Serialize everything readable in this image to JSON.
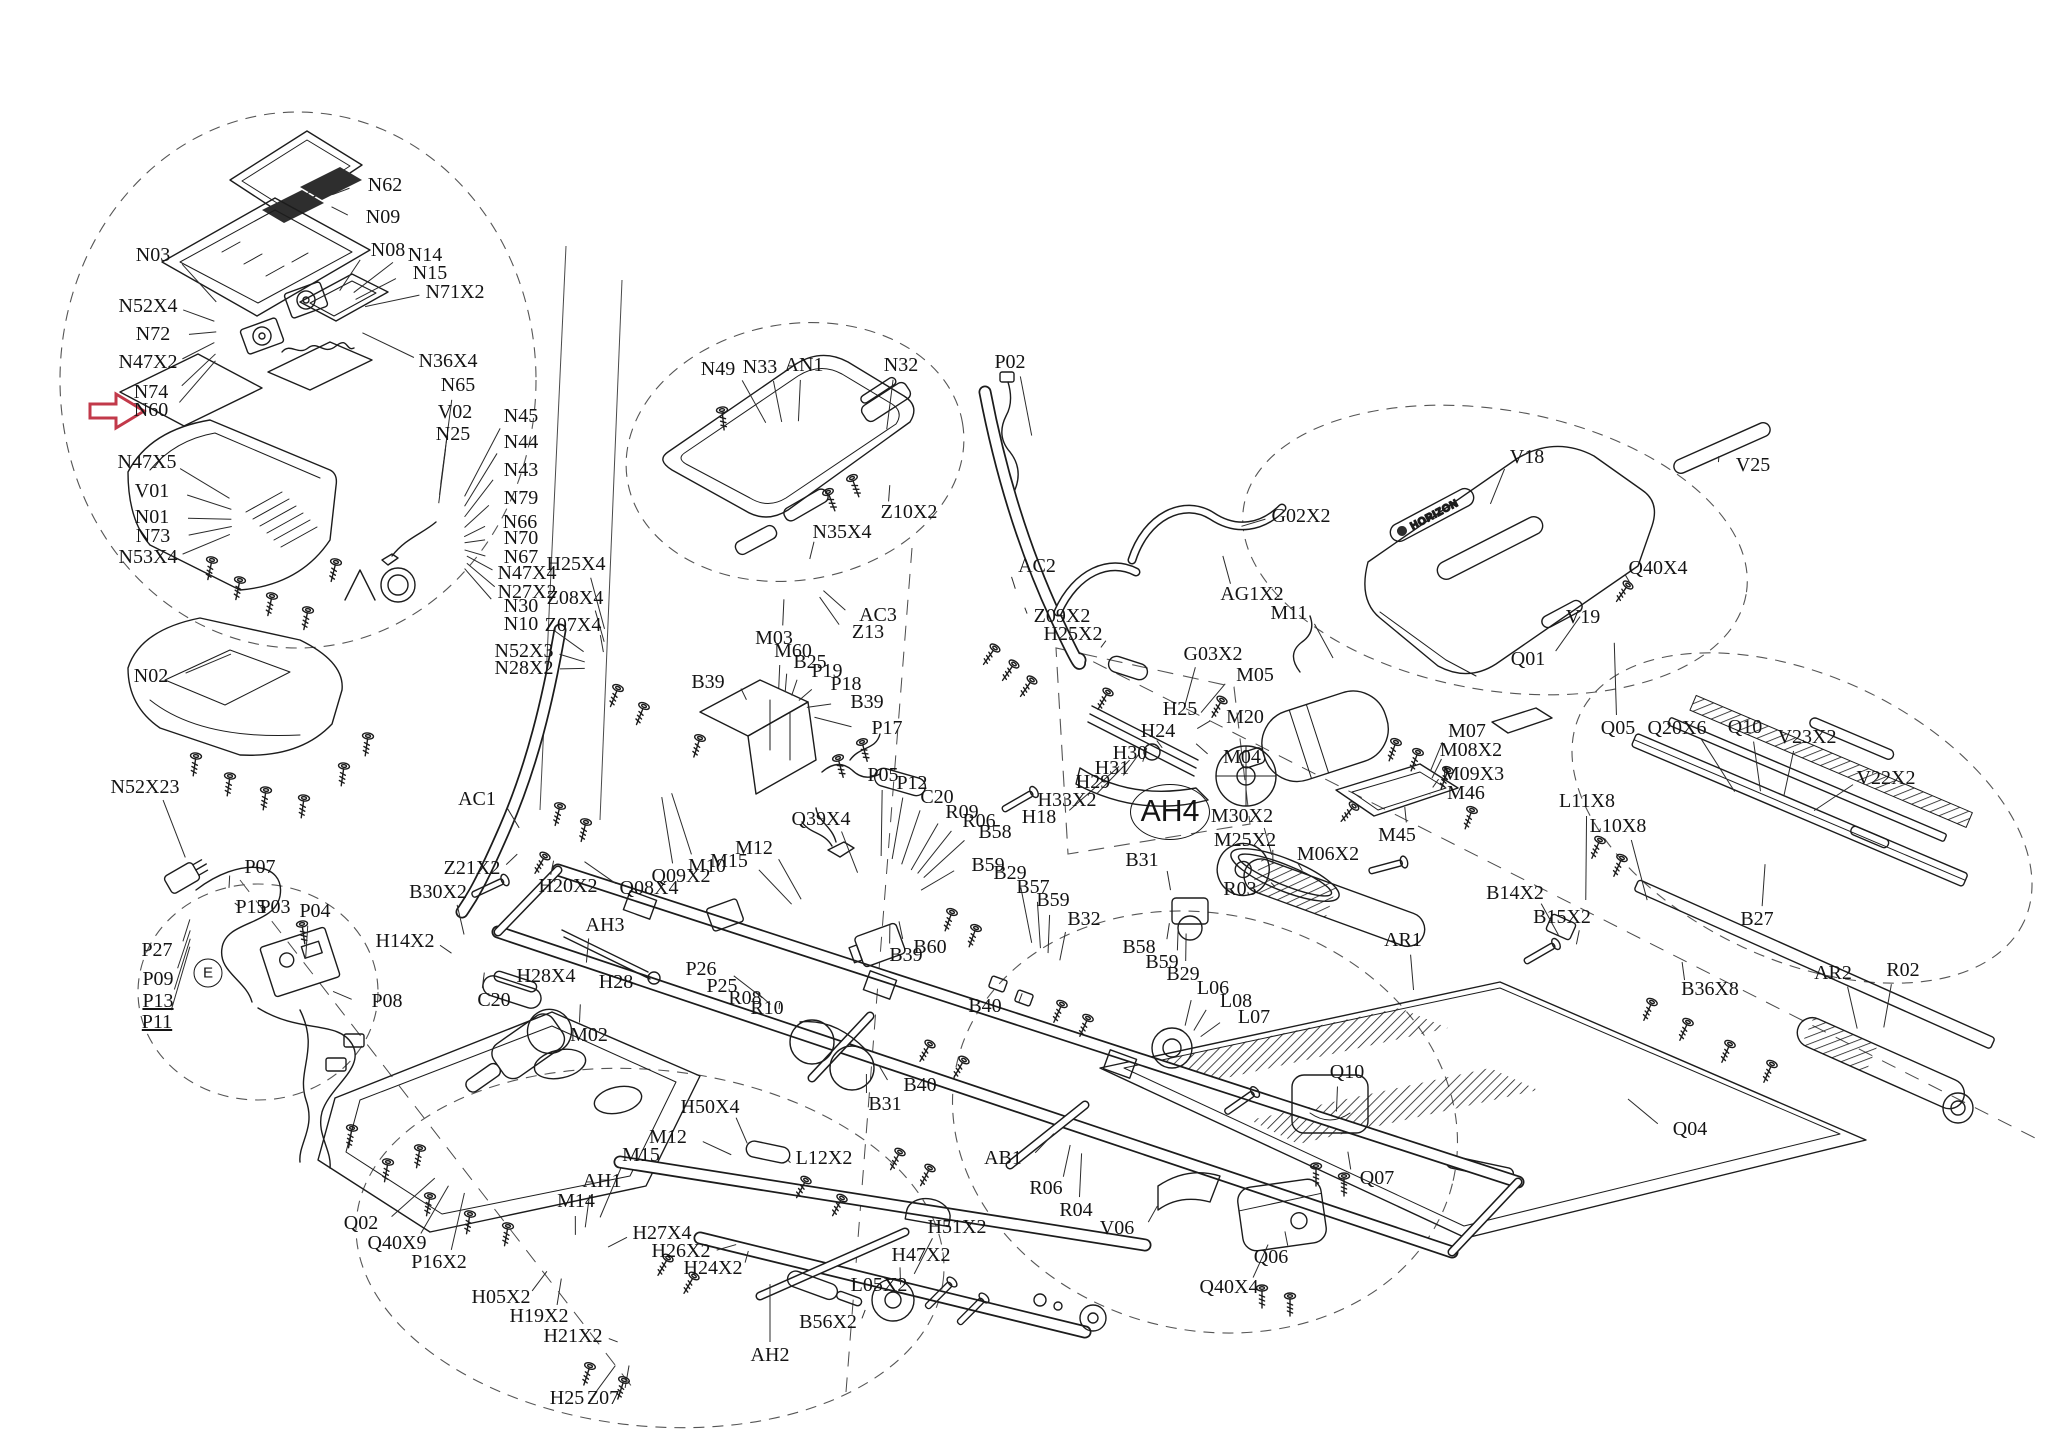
{
  "page": {
    "bg": "#ffffff",
    "ink": "#1c1c1c",
    "accent_red": "#c2394a"
  },
  "diagram": {
    "type": "exploded-parts-diagram",
    "subject": "treadmill",
    "brand_logo_text": "HORIZON",
    "highlighted_part": "N60",
    "tags": [
      {
        "t": "AH4",
        "x": 1170,
        "y": 812,
        "w": 78,
        "h": 54
      },
      {
        "t": "E",
        "x": 208,
        "y": 973,
        "w": 27,
        "h": 27
      }
    ],
    "labels": [
      {
        "t": "N62",
        "x": 385,
        "y": 186
      },
      {
        "t": "N09",
        "x": 383,
        "y": 218
      },
      {
        "t": "N08",
        "x": 388,
        "y": 251
      },
      {
        "t": "N14",
        "x": 425,
        "y": 256
      },
      {
        "t": "N15",
        "x": 430,
        "y": 274
      },
      {
        "t": "N71X2",
        "x": 455,
        "y": 293
      },
      {
        "t": "N03",
        "x": 153,
        "y": 256
      },
      {
        "t": "N52X4",
        "x": 148,
        "y": 307
      },
      {
        "t": "N72",
        "x": 153,
        "y": 335
      },
      {
        "t": "N47X2",
        "x": 148,
        "y": 363
      },
      {
        "t": "N74",
        "x": 151,
        "y": 393
      },
      {
        "t": "N60",
        "x": 151,
        "y": 411
      },
      {
        "t": "N36X4",
        "x": 448,
        "y": 362
      },
      {
        "t": "N65",
        "x": 458,
        "y": 386
      },
      {
        "t": "V02",
        "x": 455,
        "y": 413
      },
      {
        "t": "N25",
        "x": 453,
        "y": 435
      },
      {
        "t": "N47X5",
        "x": 147,
        "y": 463
      },
      {
        "t": "V01",
        "x": 152,
        "y": 492
      },
      {
        "t": "N01",
        "x": 152,
        "y": 518
      },
      {
        "t": "N73",
        "x": 153,
        "y": 537
      },
      {
        "t": "N53X4",
        "x": 148,
        "y": 558
      },
      {
        "t": "N02",
        "x": 151,
        "y": 677
      },
      {
        "t": "N52X23",
        "x": 145,
        "y": 788
      },
      {
        "t": "N45",
        "x": 521,
        "y": 417
      },
      {
        "t": "N44",
        "x": 521,
        "y": 443
      },
      {
        "t": "N43",
        "x": 521,
        "y": 471
      },
      {
        "t": "N79",
        "x": 521,
        "y": 499
      },
      {
        "t": "N66",
        "x": 520,
        "y": 523
      },
      {
        "t": "N70",
        "x": 521,
        "y": 539
      },
      {
        "t": "N67",
        "x": 521,
        "y": 558
      },
      {
        "t": "N47X4",
        "x": 527,
        "y": 574
      },
      {
        "t": "N27X2",
        "x": 527,
        "y": 593
      },
      {
        "t": "N30",
        "x": 521,
        "y": 607
      },
      {
        "t": "N10",
        "x": 521,
        "y": 625
      },
      {
        "t": "N52X3",
        "x": 524,
        "y": 652
      },
      {
        "t": "N28X2",
        "x": 524,
        "y": 669
      },
      {
        "t": "N49",
        "x": 718,
        "y": 370
      },
      {
        "t": "N33",
        "x": 760,
        "y": 368
      },
      {
        "t": "AN1",
        "x": 804,
        "y": 366
      },
      {
        "t": "N32",
        "x": 901,
        "y": 366
      },
      {
        "t": "P02",
        "x": 1010,
        "y": 363
      },
      {
        "t": "Z10X2",
        "x": 909,
        "y": 513
      },
      {
        "t": "N35X4",
        "x": 842,
        "y": 533
      },
      {
        "t": "AC2",
        "x": 1037,
        "y": 567
      },
      {
        "t": "AC1",
        "x": 477,
        "y": 800
      },
      {
        "t": "H25X4",
        "x": 576,
        "y": 565
      },
      {
        "t": "Z08X4",
        "x": 575,
        "y": 599
      },
      {
        "t": "Z07X4",
        "x": 573,
        "y": 626
      },
      {
        "t": "AC3",
        "x": 878,
        "y": 616
      },
      {
        "t": "Z13",
        "x": 868,
        "y": 633
      },
      {
        "t": "M03",
        "x": 774,
        "y": 639
      },
      {
        "t": "M60",
        "x": 793,
        "y": 652
      },
      {
        "t": "B25",
        "x": 810,
        "y": 663
      },
      {
        "t": "P19",
        "x": 827,
        "y": 672
      },
      {
        "t": "P18",
        "x": 846,
        "y": 685
      },
      {
        "t": "B39",
        "x": 708,
        "y": 683
      },
      {
        "t": "B39",
        "x": 867,
        "y": 703
      },
      {
        "t": "P17",
        "x": 887,
        "y": 729
      },
      {
        "t": "P05",
        "x": 883,
        "y": 776
      },
      {
        "t": "P12",
        "x": 912,
        "y": 784
      },
      {
        "t": "C20",
        "x": 937,
        "y": 798
      },
      {
        "t": "Z09X2",
        "x": 1062,
        "y": 617
      },
      {
        "t": "H25X2",
        "x": 1073,
        "y": 635
      },
      {
        "t": "G03X2",
        "x": 1213,
        "y": 655
      },
      {
        "t": "H25",
        "x": 1180,
        "y": 710
      },
      {
        "t": "H24",
        "x": 1158,
        "y": 732
      },
      {
        "t": "H30",
        "x": 1130,
        "y": 754
      },
      {
        "t": "H31",
        "x": 1112,
        "y": 769
      },
      {
        "t": "H29",
        "x": 1093,
        "y": 783
      },
      {
        "t": "H33X2",
        "x": 1067,
        "y": 801
      },
      {
        "t": "H18",
        "x": 1039,
        "y": 818
      },
      {
        "t": "G02X2",
        "x": 1301,
        "y": 517
      },
      {
        "t": "AG1X2",
        "x": 1252,
        "y": 595
      },
      {
        "t": "M11",
        "x": 1289,
        "y": 614
      },
      {
        "t": "V18",
        "x": 1527,
        "y": 458
      },
      {
        "t": "Q01",
        "x": 1528,
        "y": 660
      },
      {
        "t": "V25",
        "x": 1753,
        "y": 466
      },
      {
        "t": "Q40X4",
        "x": 1658,
        "y": 569
      },
      {
        "t": "V19",
        "x": 1583,
        "y": 618
      },
      {
        "t": "M05",
        "x": 1255,
        "y": 676
      },
      {
        "t": "M20",
        "x": 1245,
        "y": 718
      },
      {
        "t": "M04",
        "x": 1242,
        "y": 758
      },
      {
        "t": "M07",
        "x": 1467,
        "y": 732
      },
      {
        "t": "M08X2",
        "x": 1471,
        "y": 751
      },
      {
        "t": "M09X3",
        "x": 1473,
        "y": 775
      },
      {
        "t": "M46",
        "x": 1466,
        "y": 794
      },
      {
        "t": "M45",
        "x": 1397,
        "y": 836
      },
      {
        "t": "M30X2",
        "x": 1242,
        "y": 817
      },
      {
        "t": "M25X2",
        "x": 1245,
        "y": 841
      },
      {
        "t": "M06X2",
        "x": 1328,
        "y": 855
      },
      {
        "t": "R03",
        "x": 1240,
        "y": 890
      },
      {
        "t": "B14X2",
        "x": 1515,
        "y": 894
      },
      {
        "t": "B15X2",
        "x": 1562,
        "y": 918
      },
      {
        "t": "AR1",
        "x": 1403,
        "y": 941
      },
      {
        "t": "Q05",
        "x": 1618,
        "y": 729
      },
      {
        "t": "Q20X6",
        "x": 1677,
        "y": 729
      },
      {
        "t": "Q10",
        "x": 1745,
        "y": 728
      },
      {
        "t": "V23X2",
        "x": 1807,
        "y": 738
      },
      {
        "t": "V22X2",
        "x": 1886,
        "y": 779
      },
      {
        "t": "L11X8",
        "x": 1587,
        "y": 802
      },
      {
        "t": "L10X8",
        "x": 1618,
        "y": 827
      },
      {
        "t": "B27",
        "x": 1757,
        "y": 920
      },
      {
        "t": "B36X8",
        "x": 1710,
        "y": 990
      },
      {
        "t": "AR2",
        "x": 1833,
        "y": 974
      },
      {
        "t": "R02",
        "x": 1903,
        "y": 971
      },
      {
        "t": "Q39X4",
        "x": 821,
        "y": 820
      },
      {
        "t": "M12",
        "x": 754,
        "y": 849
      },
      {
        "t": "M15",
        "x": 729,
        "y": 862
      },
      {
        "t": "M10",
        "x": 707,
        "y": 867
      },
      {
        "t": "Q09X2",
        "x": 681,
        "y": 877
      },
      {
        "t": "Q08X4",
        "x": 649,
        "y": 889
      },
      {
        "t": "R09",
        "x": 962,
        "y": 813
      },
      {
        "t": "R06",
        "x": 979,
        "y": 822
      },
      {
        "t": "B58",
        "x": 995,
        "y": 833
      },
      {
        "t": "B59",
        "x": 988,
        "y": 866
      },
      {
        "t": "B29",
        "x": 1010,
        "y": 874
      },
      {
        "t": "B57",
        "x": 1033,
        "y": 888
      },
      {
        "t": "B59",
        "x": 1053,
        "y": 901
      },
      {
        "t": "B60",
        "x": 930,
        "y": 948
      },
      {
        "t": "B39",
        "x": 906,
        "y": 956
      },
      {
        "t": "B40",
        "x": 985,
        "y": 1007
      },
      {
        "t": "B40",
        "x": 920,
        "y": 1086
      },
      {
        "t": "B31",
        "x": 885,
        "y": 1105
      },
      {
        "t": "B32",
        "x": 1084,
        "y": 920
      },
      {
        "t": "B31",
        "x": 1142,
        "y": 861
      },
      {
        "t": "R08",
        "x": 745,
        "y": 999
      },
      {
        "t": "R10",
        "x": 767,
        "y": 1009
      },
      {
        "t": "P26",
        "x": 701,
        "y": 970
      },
      {
        "t": "P25",
        "x": 722,
        "y": 987
      },
      {
        "t": "B58",
        "x": 1139,
        "y": 948
      },
      {
        "t": "B59",
        "x": 1162,
        "y": 963
      },
      {
        "t": "B29",
        "x": 1183,
        "y": 975
      },
      {
        "t": "L06",
        "x": 1213,
        "y": 989
      },
      {
        "t": "L08",
        "x": 1236,
        "y": 1002
      },
      {
        "t": "L07",
        "x": 1254,
        "y": 1018
      },
      {
        "t": "Z21X2",
        "x": 472,
        "y": 869
      },
      {
        "t": "B30X2",
        "x": 438,
        "y": 893
      },
      {
        "t": "H20X2",
        "x": 568,
        "y": 887
      },
      {
        "t": "AH3",
        "x": 605,
        "y": 926
      },
      {
        "t": "H28X4",
        "x": 546,
        "y": 977
      },
      {
        "t": "H28",
        "x": 616,
        "y": 983
      },
      {
        "t": "C20",
        "x": 494,
        "y": 1001
      },
      {
        "t": "M02",
        "x": 589,
        "y": 1036
      },
      {
        "t": "H14X2",
        "x": 405,
        "y": 942
      },
      {
        "t": "P07",
        "x": 260,
        "y": 868
      },
      {
        "t": "P15",
        "x": 251,
        "y": 908
      },
      {
        "t": "P03",
        "x": 275,
        "y": 908
      },
      {
        "t": "P04",
        "x": 315,
        "y": 912
      },
      {
        "t": "P27",
        "x": 157,
        "y": 951
      },
      {
        "t": "P09",
        "x": 158,
        "y": 980
      },
      {
        "t": "P13",
        "x": 158,
        "y": 1002,
        "u": true
      },
      {
        "t": "P11",
        "x": 157,
        "y": 1023,
        "u": true
      },
      {
        "t": "P08",
        "x": 387,
        "y": 1002
      },
      {
        "t": "H50X4",
        "x": 710,
        "y": 1108
      },
      {
        "t": "M12",
        "x": 668,
        "y": 1138
      },
      {
        "t": "M15",
        "x": 641,
        "y": 1156
      },
      {
        "t": "AH1",
        "x": 602,
        "y": 1182
      },
      {
        "t": "M14",
        "x": 576,
        "y": 1202
      },
      {
        "t": "H27X4",
        "x": 662,
        "y": 1234
      },
      {
        "t": "H26X2",
        "x": 681,
        "y": 1252
      },
      {
        "t": "H24X2",
        "x": 713,
        "y": 1269
      },
      {
        "t": "Q02",
        "x": 361,
        "y": 1224
      },
      {
        "t": "Q40X9",
        "x": 397,
        "y": 1244
      },
      {
        "t": "P16X2",
        "x": 439,
        "y": 1263
      },
      {
        "t": "H05X2",
        "x": 501,
        "y": 1298
      },
      {
        "t": "H19X2",
        "x": 539,
        "y": 1317
      },
      {
        "t": "H21X2",
        "x": 573,
        "y": 1337
      },
      {
        "t": "H25",
        "x": 567,
        "y": 1399
      },
      {
        "t": "Z07",
        "x": 603,
        "y": 1399
      },
      {
        "t": "L12X2",
        "x": 824,
        "y": 1159
      },
      {
        "t": "H51X2",
        "x": 957,
        "y": 1228
      },
      {
        "t": "H47X2",
        "x": 921,
        "y": 1256
      },
      {
        "t": "L05X2",
        "x": 879,
        "y": 1286
      },
      {
        "t": "B56X2",
        "x": 828,
        "y": 1323
      },
      {
        "t": "AH2",
        "x": 770,
        "y": 1356
      },
      {
        "t": "AB1",
        "x": 1003,
        "y": 1159
      },
      {
        "t": "R06",
        "x": 1046,
        "y": 1189
      },
      {
        "t": "R04",
        "x": 1076,
        "y": 1211
      },
      {
        "t": "V06",
        "x": 1117,
        "y": 1229
      },
      {
        "t": "Q06",
        "x": 1271,
        "y": 1258
      },
      {
        "t": "Q40X4",
        "x": 1229,
        "y": 1288
      },
      {
        "t": "Q07",
        "x": 1377,
        "y": 1179
      },
      {
        "t": "Q10",
        "x": 1347,
        "y": 1073
      },
      {
        "t": "Q04",
        "x": 1690,
        "y": 1130
      }
    ]
  }
}
